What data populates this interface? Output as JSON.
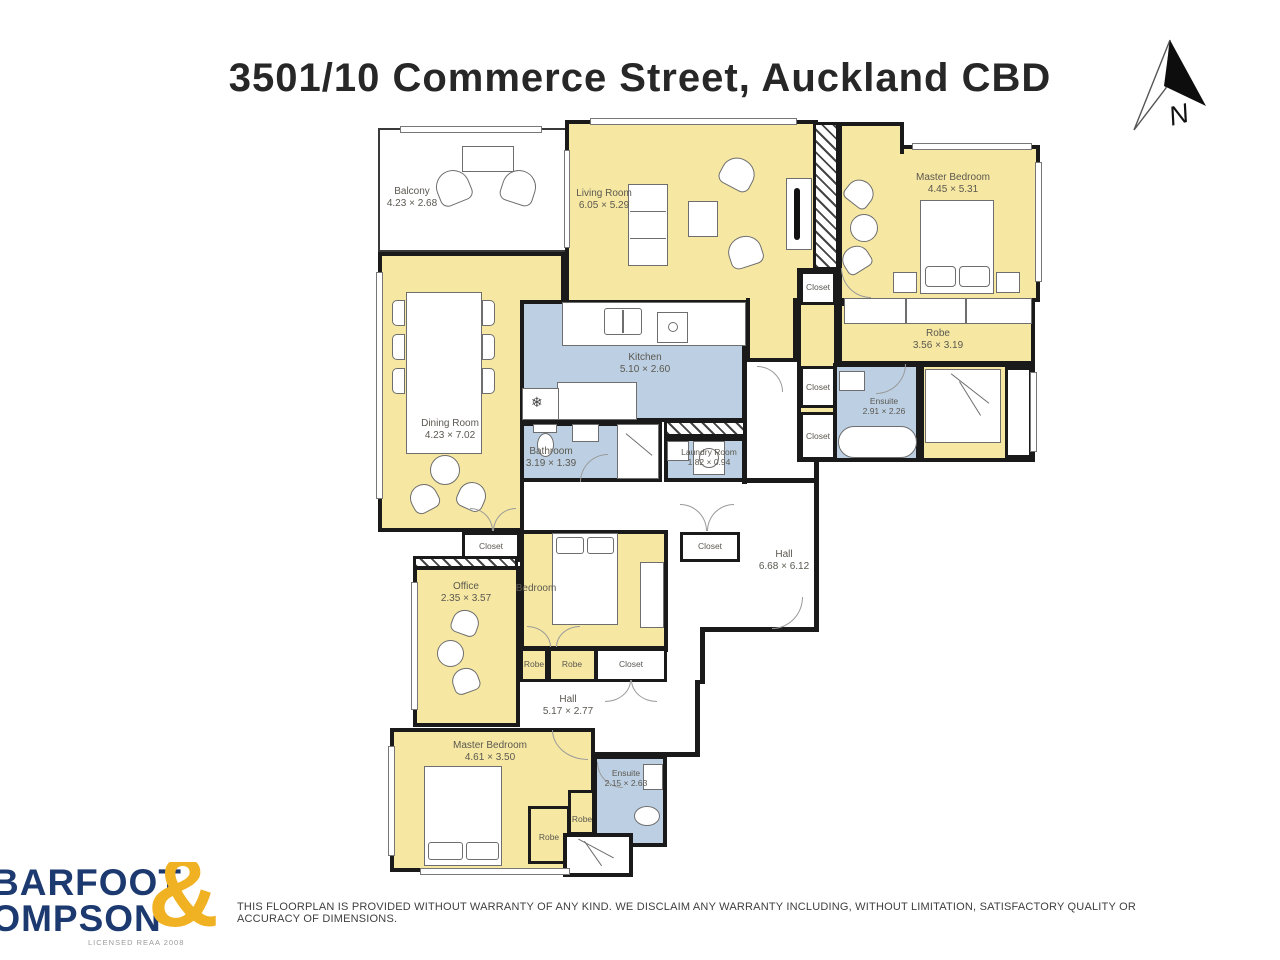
{
  "title": "3501/10 Commerce Street, Auckland CBD",
  "north_label": "N",
  "rooms": {
    "balcony": {
      "name": "Balcony",
      "dims": "4.23 × 2.68"
    },
    "living": {
      "name": "Living Room",
      "dims": "6.05 × 5.29"
    },
    "master_top": {
      "name": "Master Bedroom",
      "dims": "4.45 × 5.31"
    },
    "robe_top": {
      "name": "Robe",
      "dims": "3.56 × 3.19"
    },
    "ensuite_top": {
      "name": "Ensuite",
      "dims": "2.91 × 2.26"
    },
    "kitchen": {
      "name": "Kitchen",
      "dims": "5.10 × 2.60"
    },
    "dining": {
      "name": "Dining Room",
      "dims": "4.23 × 7.02"
    },
    "bathroom": {
      "name": "Bathroom",
      "dims": "3.19 × 1.39"
    },
    "laundry": {
      "name": "Laundry Room",
      "dims": "1.82 × 0.94"
    },
    "hall_main": {
      "name": "Hall",
      "dims": "6.68 × 6.12"
    },
    "office": {
      "name": "Office",
      "dims": "2.35 × 3.57"
    },
    "bedroom": {
      "name": "Bedroom",
      "dims": ""
    },
    "hall_lower": {
      "name": "Hall",
      "dims": "5.17 × 2.77"
    },
    "master_bottom": {
      "name": "Master Bedroom",
      "dims": "4.61 × 3.50"
    },
    "ensuite_bottom": {
      "name": "Ensuite",
      "dims": "2.15 × 2.63"
    }
  },
  "labels": {
    "closet": "Closet",
    "robe": "Robe"
  },
  "icons": {
    "fridge_snowflake": "❄"
  },
  "logo": {
    "line1": "BARFOOT",
    "line2": "THOMPSON",
    "ampersand": "&",
    "licence": "LICENSED REAA 2008"
  },
  "disclaimer": "THIS FLOORPLAN IS PROVIDED WITHOUT WARRANTY OF ANY KIND. WE DISCLAIM ANY WARRANTY INCLUDING, WITHOUT LIMITATION, SATISFACTORY QUALITY OR ACCURACY OF DIMENSIONS.",
  "colors": {
    "room_yellow": "#f6e8a3",
    "room_blue": "#bdd0e3",
    "wall": "#1a1a1a",
    "logo_navy": "#1d3a70",
    "logo_gold": "#f0b222"
  }
}
